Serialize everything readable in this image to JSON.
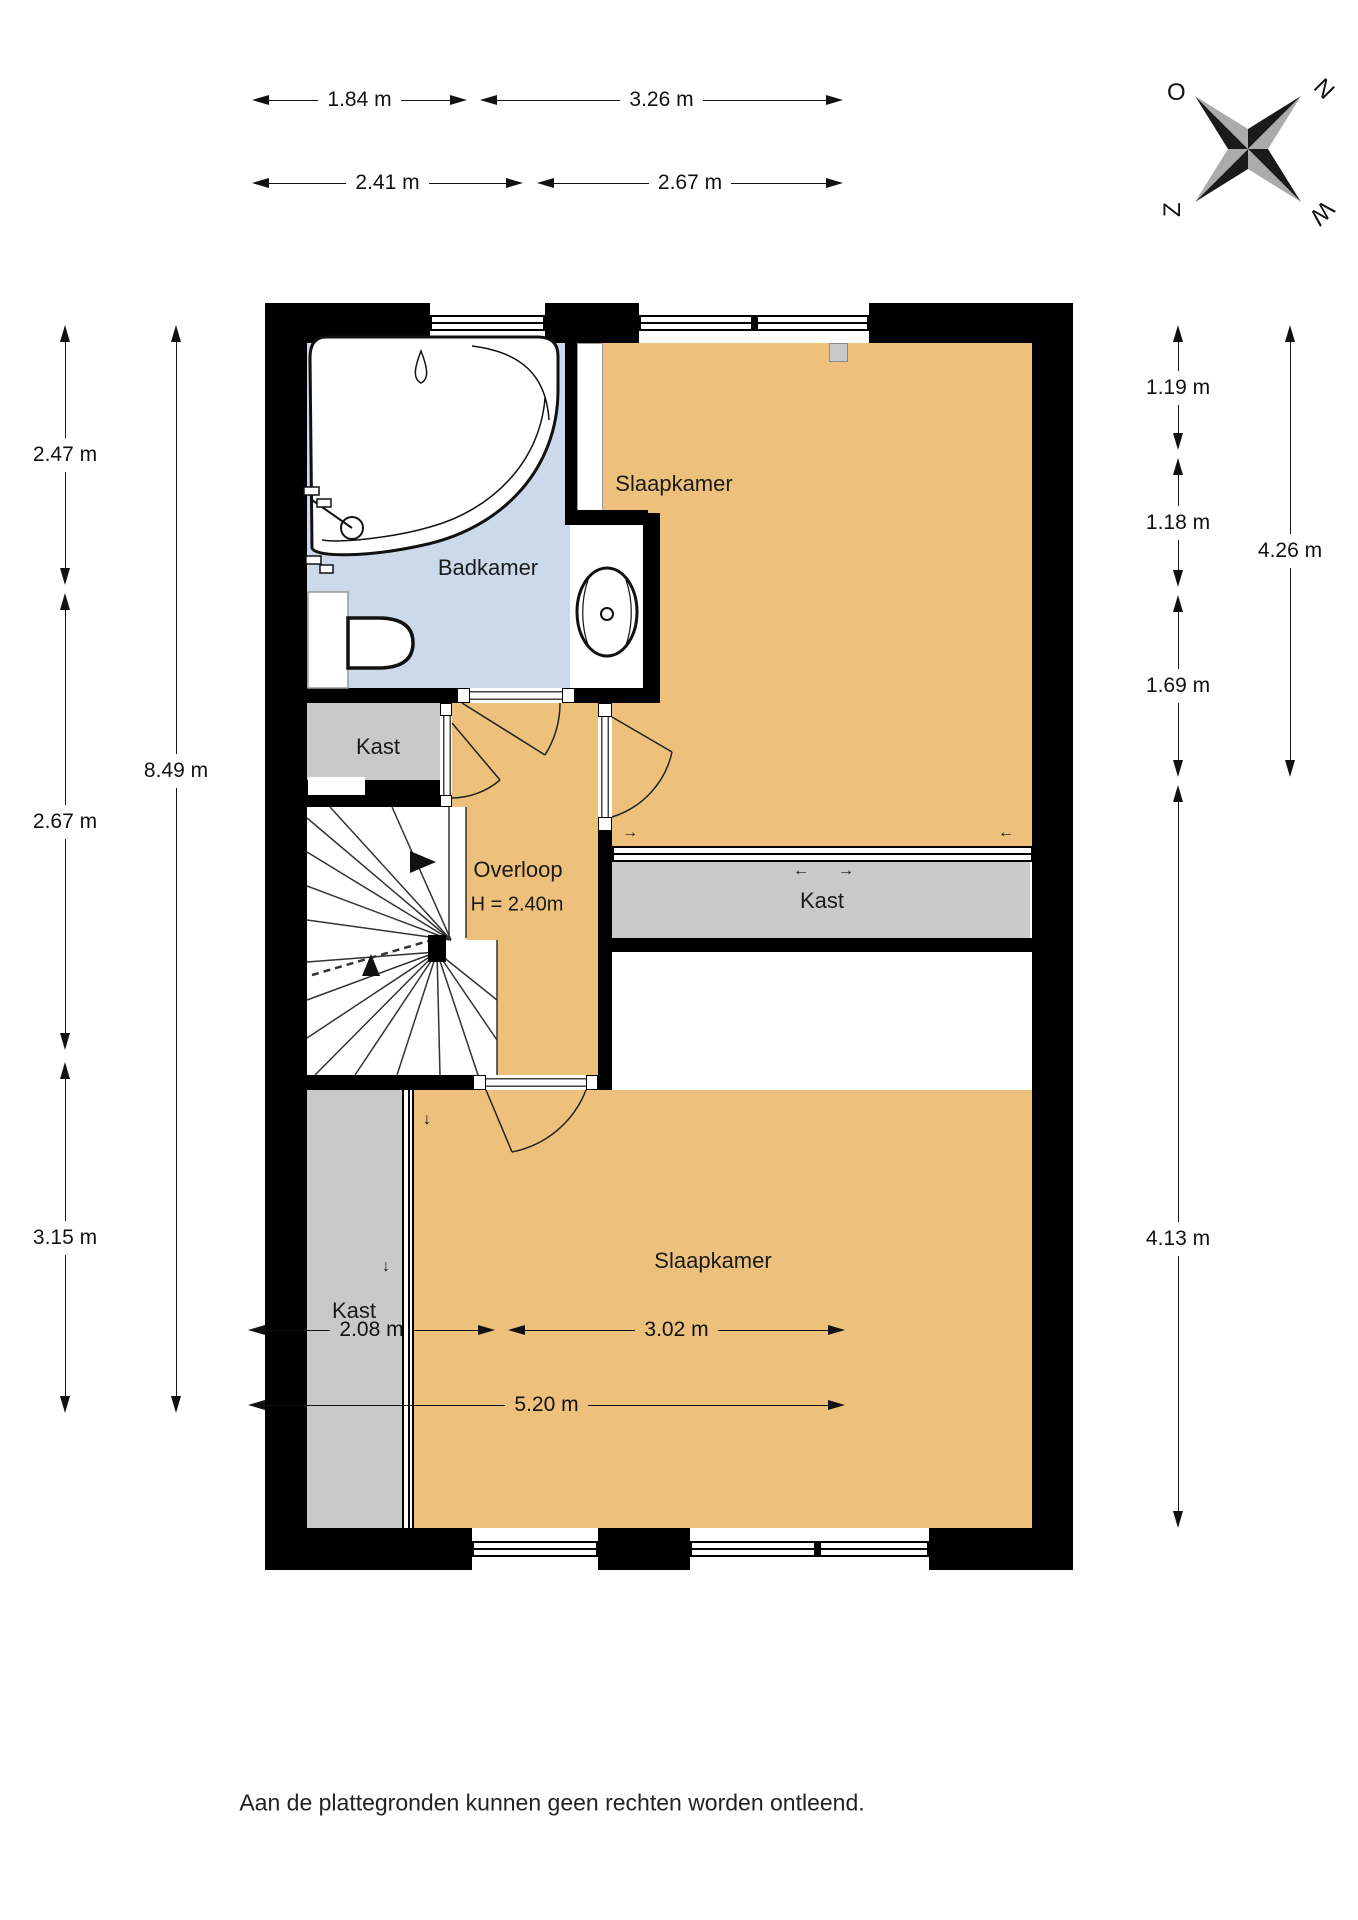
{
  "title": "floor-plan-first-floor",
  "rooms": {
    "badkamer": "Badkamer",
    "slaapkamer_top": "Slaapkamer",
    "slaapkamer_bottom": "Slaapkamer",
    "kast_top": "Kast",
    "kast_mid": "Kast",
    "kast_bottom": "Kast",
    "overloop": "Overloop",
    "overloop_height": "H = 2.40m"
  },
  "dims": {
    "t1a": "1.84 m",
    "t1b": "3.26 m",
    "t2a": "2.41 m",
    "t2b": "2.67 m",
    "l1": "2.47 m",
    "l2": "2.67 m",
    "l3": "3.15 m",
    "l_total": "8.49 m",
    "r1": "1.19 m",
    "r2": "1.18 m",
    "r3": "1.69 m",
    "r4": "4.13 m",
    "r_total": "4.26 m",
    "b1a": "2.08 m",
    "b1b": "3.02 m",
    "b_total": "5.20 m"
  },
  "compass": {
    "o": "O",
    "n": "N",
    "z": "Z",
    "w": "W"
  },
  "glyphs": {
    "arrow_right": "→",
    "arrow_left": "←",
    "arrow_down": "↓"
  },
  "footer": {
    "disclaimer": "Aan de plattegronden kunnen geen rechten worden ontleend."
  },
  "colors": {
    "wall": "#000000",
    "floor_orange": "#edc07c",
    "floor_blue": "#ccd9ea",
    "floor_gray": "#c9c9c9",
    "line": "#111111"
  }
}
